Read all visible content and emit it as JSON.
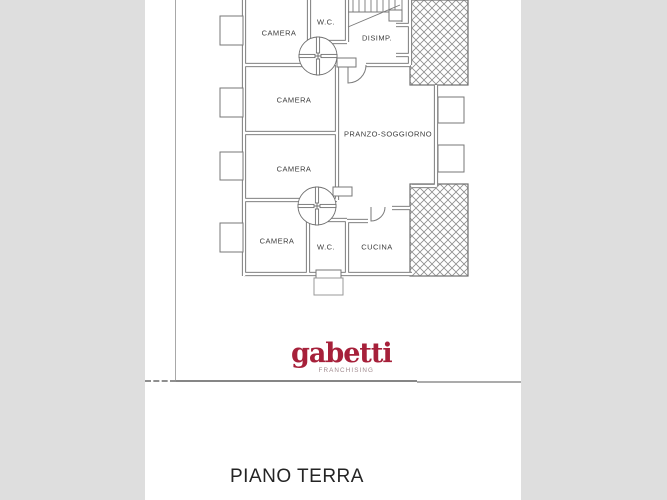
{
  "page": {
    "background_color": "#dedede",
    "sheet_color": "#ffffff"
  },
  "floor_plan": {
    "rooms": [
      {
        "id": "camera-1",
        "label": "CAMERA"
      },
      {
        "id": "wc-top",
        "label": "W.C."
      },
      {
        "id": "disimpegno",
        "label": "DISIMP."
      },
      {
        "id": "camera-2",
        "label": "CAMERA"
      },
      {
        "id": "pranzo-soggiorno",
        "label": "PRANZO-SOGGIORNO"
      },
      {
        "id": "camera-3",
        "label": "CAMERA"
      },
      {
        "id": "camera-4",
        "label": "CAMERA"
      },
      {
        "id": "wc-bottom",
        "label": "W.C."
      },
      {
        "id": "cucina",
        "label": "CUCINA"
      }
    ]
  },
  "branding": {
    "logo_text": "gabetti",
    "logo_subtext": "FRANCHISING",
    "logo_color": "#a6203a",
    "logo_subtext_color": "#a08a8e"
  },
  "caption": {
    "title": "PIANO TERRA"
  }
}
